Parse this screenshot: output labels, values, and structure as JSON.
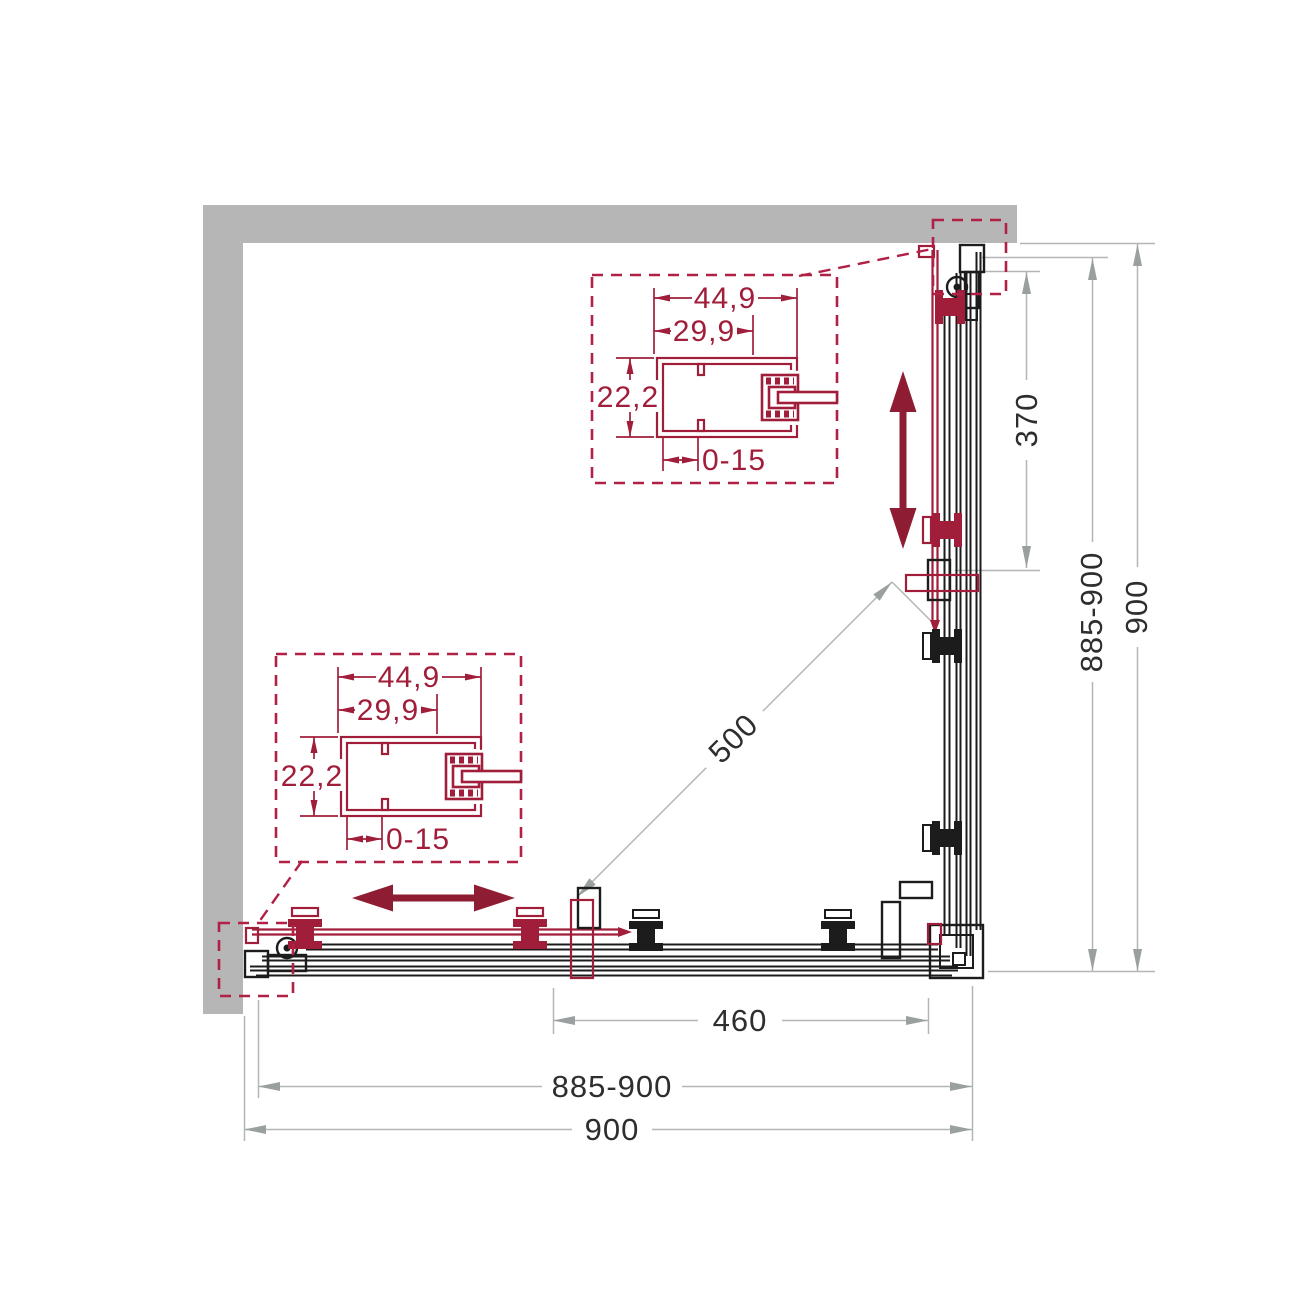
{
  "diagram": {
    "colors": {
      "wall_gray": "#b6b6b6",
      "outline_black": "#1c1c1c",
      "accent_crimson": "#a11e3a",
      "slide_arrow_maroon": "#8e1d33",
      "dim_line_gray": "#b3b6b6",
      "dim_text": "#2e2e2e"
    },
    "dimensions": {
      "width_overall": "900",
      "width_adjustable": "885-900",
      "depth_overall": "900",
      "depth_adjustable": "885-900",
      "door_opening": "460",
      "door_travel": "370",
      "diagonal_entry": "500"
    },
    "profile_detail": {
      "outer_width": "44,9",
      "inner_width": "29,9",
      "depth": "22,2",
      "wall_adjustment": "0-15"
    }
  }
}
